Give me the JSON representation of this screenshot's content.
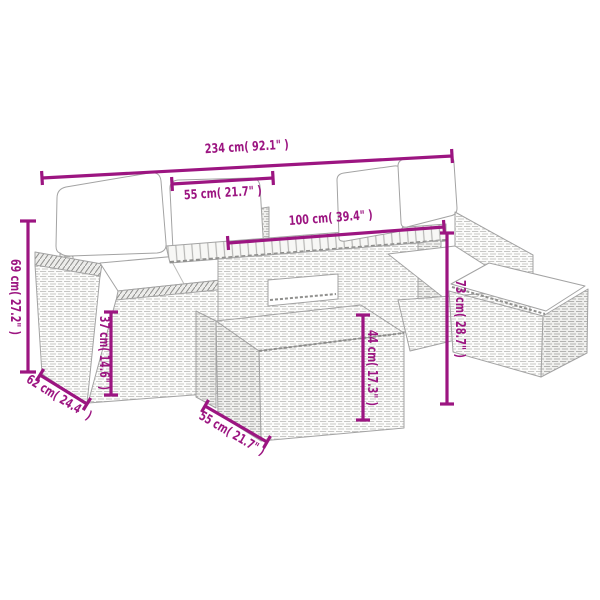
{
  "diagram": {
    "type": "product-dimension-diagram",
    "subject": "6-piece poly rattan garden lounge set with cushions, slatted-top table and footstools",
    "accent_color": "#9c1581",
    "furniture_line_color": "#a3a3a3",
    "dimensions": {
      "total_width": "234 cm( 92.1\" )",
      "seat_width": "55 cm( 21.7\" )",
      "table_length": "100 cm( 39.4\" )",
      "back_height": "69 cm( 27.2\" )",
      "seat_height": "37 cm( 14.6\" )",
      "seat_depth": "62 cm( 24.4\" )",
      "stool_width": "55 cm( 21.7\" )",
      "stool_height": "44 cm( 17.3\" )",
      "table_height": "73 cm( 28.7\" )"
    }
  }
}
